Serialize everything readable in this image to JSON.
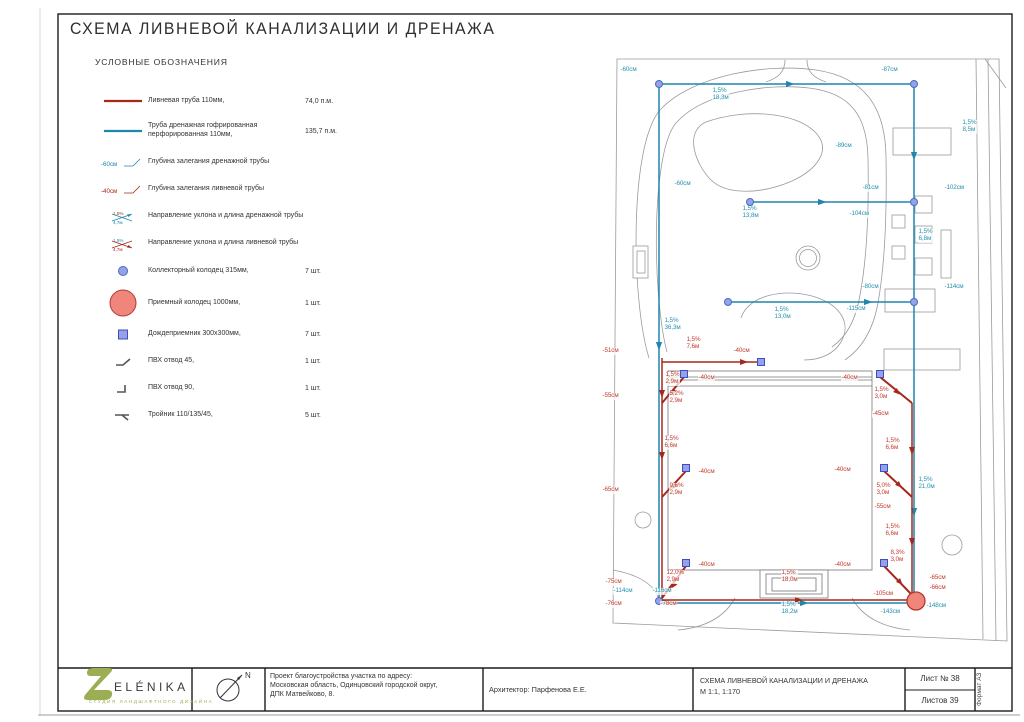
{
  "page": {
    "title": "СХЕМА ЛИВНЕВОЙ КАНАЛИЗАЦИИ И ДРЕНАЖА"
  },
  "colors": {
    "storm": "#a5281b",
    "storm_label": "#c23b2e",
    "drain": "#1f86ad",
    "drain_label": "#2492ae",
    "collector_fill": "#98a0e8",
    "collector_stroke": "#3f6fc1",
    "inlet_fill": "#98a0e8",
    "inlet_stroke": "#3a4fc1",
    "receiving_fill": "#f0857c",
    "receiving_stroke": "#b03a2e",
    "logo_green": "#9bae53"
  },
  "legend": {
    "heading": "УСЛОВНЫЕ ОБОЗНАЧЕНИЯ",
    "items": [
      {
        "symbol": "storm-pipe-line",
        "label": "Ливневая труба 110мм,",
        "value": "74,0 п.м."
      },
      {
        "symbol": "drain-pipe-line",
        "label": "Труба дренажная гофрированная перфорированная 110мм,",
        "value": "135,7 п.м."
      },
      {
        "symbol": "drain-depth",
        "sym_lines": [
          "-60см"
        ],
        "label": "Глубина залегания дренажной трубы",
        "value": ""
      },
      {
        "symbol": "storm-depth",
        "sym_lines": [
          "-40см"
        ],
        "label": "Глубина залегания ливневой трубы",
        "value": ""
      },
      {
        "symbol": "drain-slope",
        "sym_lines": [
          "1,5%",
          "4,7м"
        ],
        "label": "Направление уклона и длина дренажной трубы",
        "value": ""
      },
      {
        "symbol": "storm-slope",
        "sym_lines": [
          "1,5%",
          "4,7м"
        ],
        "label": "Направление уклона и длина ливневой трубы",
        "value": ""
      },
      {
        "symbol": "collector-well",
        "label": "Коллекторный колодец 315мм,",
        "value": "7 шт."
      },
      {
        "symbol": "receiving-well",
        "label": "Приемный колодец 1000мм,",
        "value": "1 шт."
      },
      {
        "symbol": "rain-inlet",
        "label": "Дождеприемник 300х300мм,",
        "value": "7 шт."
      },
      {
        "symbol": "pvc-bend-45",
        "label": "ПВХ отвод 45,",
        "value": "1 шт."
      },
      {
        "symbol": "pvc-bend-90",
        "label": "ПВХ отвод 90,",
        "value": "1 шт."
      },
      {
        "symbol": "tee-fitting",
        "label": "Тройник 110/135/45,",
        "value": "5 шт."
      }
    ]
  },
  "plan": {
    "annotations": [
      {
        "x": 620,
        "y": 67,
        "c": "d",
        "l": [
          "-60см"
        ]
      },
      {
        "x": 881,
        "y": 67,
        "c": "d",
        "l": [
          "-87см"
        ]
      },
      {
        "x": 712,
        "y": 88,
        "c": "d",
        "l": [
          "1,5%",
          "18,3м"
        ]
      },
      {
        "x": 835,
        "y": 143,
        "c": "d",
        "l": [
          "-89см"
        ]
      },
      {
        "x": 962,
        "y": 120,
        "c": "d",
        "l": [
          "1,5%",
          "8,5м"
        ]
      },
      {
        "x": 674,
        "y": 181,
        "c": "d",
        "l": [
          "-60см"
        ]
      },
      {
        "x": 742,
        "y": 206,
        "c": "d",
        "l": [
          "1,5%",
          "13,8м"
        ]
      },
      {
        "x": 862,
        "y": 185,
        "c": "d",
        "l": [
          "-81см"
        ]
      },
      {
        "x": 944,
        "y": 185,
        "c": "d",
        "l": [
          "-102см"
        ]
      },
      {
        "x": 849,
        "y": 211,
        "c": "d",
        "l": [
          "-104см"
        ]
      },
      {
        "x": 918,
        "y": 229,
        "c": "d",
        "l": [
          "1,5%",
          "6,8м"
        ]
      },
      {
        "x": 862,
        "y": 284,
        "c": "d",
        "l": [
          "-80см"
        ]
      },
      {
        "x": 944,
        "y": 284,
        "c": "d",
        "l": [
          "-114см"
        ]
      },
      {
        "x": 846,
        "y": 306,
        "c": "d",
        "l": [
          "-115см"
        ]
      },
      {
        "x": 664,
        "y": 318,
        "c": "d",
        "l": [
          "1,5%",
          "36,3м"
        ]
      },
      {
        "x": 774,
        "y": 307,
        "c": "d",
        "l": [
          "1,5%",
          "13,0м"
        ]
      },
      {
        "x": 918,
        "y": 477,
        "c": "d",
        "l": [
          "1,5%",
          "21,0м"
        ]
      },
      {
        "x": 781,
        "y": 602,
        "c": "d",
        "l": [
          "1,5%",
          "18,2м"
        ]
      },
      {
        "x": 613,
        "y": 588,
        "c": "d",
        "l": [
          "-114см"
        ]
      },
      {
        "x": 652,
        "y": 588,
        "c": "d",
        "l": [
          "-116см"
        ]
      },
      {
        "x": 880,
        "y": 609,
        "c": "d",
        "l": [
          "-143см"
        ]
      },
      {
        "x": 926,
        "y": 603,
        "c": "d",
        "l": [
          "-148см"
        ]
      },
      {
        "x": 602,
        "y": 348,
        "c": "s",
        "l": [
          "-51см"
        ]
      },
      {
        "x": 686,
        "y": 337,
        "c": "s",
        "l": [
          "1,5%",
          "7,6м"
        ]
      },
      {
        "x": 733,
        "y": 348,
        "c": "s",
        "l": [
          "-40см"
        ]
      },
      {
        "x": 698,
        "y": 375,
        "c": "s",
        "l": [
          "-40см"
        ]
      },
      {
        "x": 841,
        "y": 375,
        "c": "s",
        "l": [
          "-40см"
        ]
      },
      {
        "x": 665,
        "y": 372,
        "c": "s",
        "l": [
          "1,5%",
          "2,9м"
        ]
      },
      {
        "x": 669,
        "y": 391,
        "c": "s",
        "l": [
          "5,2%",
          "2,9м"
        ]
      },
      {
        "x": 602,
        "y": 393,
        "c": "s",
        "l": [
          "-55см"
        ]
      },
      {
        "x": 664,
        "y": 436,
        "c": "s",
        "l": [
          "1,5%",
          "6,6м"
        ]
      },
      {
        "x": 602,
        "y": 487,
        "c": "s",
        "l": [
          "-65см"
        ]
      },
      {
        "x": 669,
        "y": 483,
        "c": "s",
        "l": [
          "9,6%",
          "2,9м"
        ]
      },
      {
        "x": 698,
        "y": 469,
        "c": "s",
        "l": [
          "-40см"
        ]
      },
      {
        "x": 666,
        "y": 570,
        "c": "s",
        "l": [
          "12,0%",
          "2,9м"
        ]
      },
      {
        "x": 698,
        "y": 562,
        "c": "s",
        "l": [
          "-40см"
        ]
      },
      {
        "x": 605,
        "y": 579,
        "c": "s",
        "l": [
          "-75см"
        ]
      },
      {
        "x": 605,
        "y": 601,
        "c": "s",
        "l": [
          "-76см"
        ]
      },
      {
        "x": 660,
        "y": 601,
        "c": "s",
        "l": [
          "-78см"
        ]
      },
      {
        "x": 781,
        "y": 570,
        "c": "s",
        "l": [
          "1,5%",
          "18,0м"
        ]
      },
      {
        "x": 874,
        "y": 387,
        "c": "s",
        "l": [
          "1,5%",
          "3,0м"
        ]
      },
      {
        "x": 872,
        "y": 411,
        "c": "s",
        "l": [
          "-45см"
        ]
      },
      {
        "x": 885,
        "y": 438,
        "c": "s",
        "l": [
          "1,5%",
          "6,6м"
        ]
      },
      {
        "x": 834,
        "y": 467,
        "c": "s",
        "l": [
          "-40см"
        ]
      },
      {
        "x": 876,
        "y": 483,
        "c": "s",
        "l": [
          "5,0%",
          "3,0м"
        ]
      },
      {
        "x": 874,
        "y": 504,
        "c": "s",
        "l": [
          "-55см"
        ]
      },
      {
        "x": 885,
        "y": 524,
        "c": "s",
        "l": [
          "1,5%",
          "6,6м"
        ]
      },
      {
        "x": 890,
        "y": 550,
        "c": "s",
        "l": [
          "8,3%",
          "3,0м"
        ]
      },
      {
        "x": 834,
        "y": 562,
        "c": "s",
        "l": [
          "-40см"
        ]
      },
      {
        "x": 873,
        "y": 591,
        "c": "s",
        "l": [
          "-105см"
        ]
      },
      {
        "x": 929,
        "y": 575,
        "c": "s",
        "l": [
          "-65см"
        ]
      },
      {
        "x": 929,
        "y": 585,
        "c": "s",
        "l": [
          "-66см"
        ]
      }
    ]
  },
  "titleblock": {
    "logo_name": "ELÉNIKA",
    "logo_tagline": "СТУДИЯ ЛАНДШАФТНОГО ДИЗАЙНА",
    "north_label": "N",
    "project": "Проект благоустройства участка по адресу:\nМосковская область, Одинцовский городской округ,\nДПК Матвейково, 8.",
    "architect": "Архитектор: Парфенова Е.Е.",
    "doc_title": "СХЕМА ЛИВНЕВОЙ КАНАЛИЗАЦИИ И ДРЕНАЖА",
    "doc_scale": "М 1:1, 1:170",
    "sheet_no": "Лист № 38",
    "sheets_total": "Листов 39",
    "format": "Формат А3"
  }
}
